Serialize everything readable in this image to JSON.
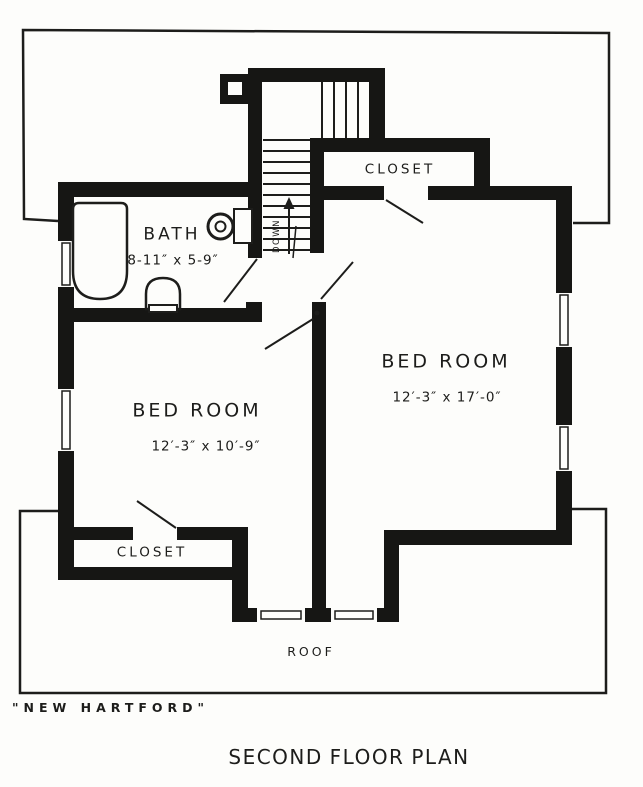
{
  "colors": {
    "ink": "#1d1d1b",
    "paper": "#fdfdfb"
  },
  "plan": {
    "rooms": {
      "closet_top": {
        "label": "CLOSET"
      },
      "bath": {
        "label": "BATH",
        "dimensions": "8-11″ x 5-9″"
      },
      "bedroom_left": {
        "label": "BED ROOM",
        "dimensions": "12′-3″ x 10′-9″"
      },
      "bedroom_right": {
        "label": "BED ROOM",
        "dimensions": "12′-3″ x 17′-0″"
      },
      "closet_bottom": {
        "label": "CLOSET"
      },
      "roof_area": {
        "label": "ROOF"
      }
    },
    "stairs": {
      "direction_label": "DOWN"
    },
    "captions": {
      "house_name": "\"NEW HARTFORD\"",
      "plan_title": "SECOND FLOOR PLAN"
    }
  }
}
